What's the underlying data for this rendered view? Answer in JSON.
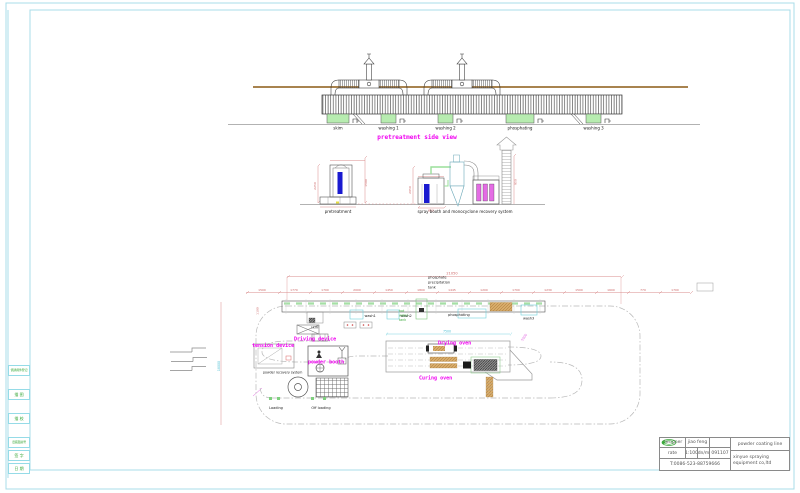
{
  "colors": {
    "frame": "#a9dce8",
    "magenta": "#f000f0",
    "dim_red": "#d98b8b",
    "cyan": "#6fd0dc",
    "green_text": "#3aa83a",
    "tank_green": "#b7ecb0",
    "beam_brown": "#a8834f",
    "blue": "#1a1ad0",
    "filter_magenta": "#e46ce4",
    "pipe_green": "#9adf9a"
  },
  "side_view": {
    "title": "pretreatment side view",
    "tanks": [
      "skim",
      "washing 1",
      "washing 2",
      "phosphating",
      "washing 3"
    ]
  },
  "elevation": {
    "pretreatment_label": "pretreatment",
    "spray_label": "spray booth and monocyclone recovery system",
    "dims": {
      "h1": "2250",
      "h2": "1500",
      "h3": "2050",
      "h4": "950",
      "w1": "850"
    }
  },
  "plan": {
    "phosphate_note": [
      "phosphate",
      "precipitation",
      "tank"
    ],
    "hot_water_note": [
      "hot",
      "water",
      "tank"
    ],
    "stations": {
      "skim": "skim",
      "wash1": "wash1",
      "wash2": "wash2",
      "phosphating": "phosphating",
      "wash3": "wash3"
    },
    "devices": {
      "tension": "tension device",
      "driving": "Driving device",
      "powder_booth": "powder booth",
      "powder_recovery": "powder recovery system",
      "loading": "Loading",
      "off_loading": "Off loading",
      "drying_oven": "Drying oven",
      "curing_oven": "Curing oven"
    },
    "dims": {
      "overall": "21050",
      "oven": "7500",
      "left_vertical": "18000",
      "band_left": "1100",
      "right_diagonal": "5000",
      "chain": [
        "1500",
        "1770",
        "1700",
        "2000",
        "1450",
        "1800",
        "1445",
        "1200",
        "1700",
        "1230",
        "1500",
        "1600",
        "770",
        "1700"
      ]
    }
  },
  "margin_block": {
    "rows": [
      "借通用件登记",
      "描 图",
      "描 校",
      "旧底图总号",
      "签 字",
      "日 期"
    ]
  },
  "title_block": {
    "designer_label": "designer",
    "designer_name": "jiao feng",
    "rate_label": "rate",
    "rate_value": "1:100",
    "unit": "dn/m",
    "drawing_no": "091107",
    "project": "powder coating line",
    "company_line1": "xinyue spraying",
    "company_line2": "equipment co,ltd",
    "phone": "T:0086-523-88759666"
  }
}
